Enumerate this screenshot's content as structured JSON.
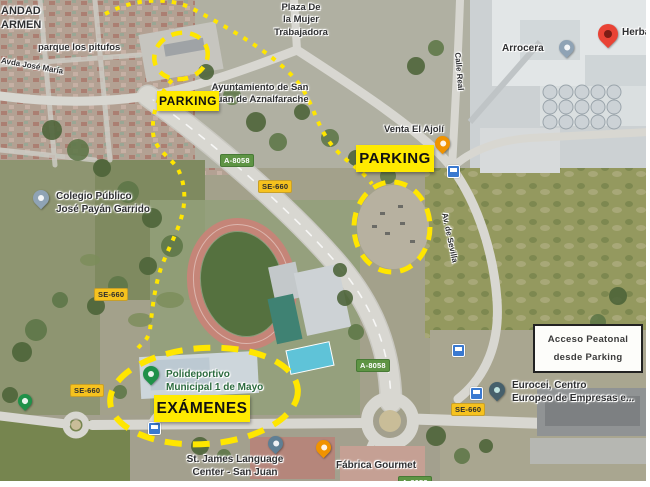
{
  "annotations": {
    "parking_top": "PARKING",
    "parking_right": "PARKING",
    "examenes": "EXÁMENES",
    "acceso_line1": "Acceso Peatonal",
    "acceso_line2": "desde Parking"
  },
  "shields": {
    "a8058": "A-8058",
    "se660": "SE-660"
  },
  "places": {
    "hermandad_line1": "ANDAD",
    "hermandad_line2": "ARMEN",
    "parque": "parque los pitufos",
    "street_jose_maria": "Avda José María",
    "plaza_line1": "Plaza De",
    "plaza_line2": "la Mujer",
    "plaza_line3": "Trabajadora",
    "ayuntamiento_line1": "Ayuntamiento de San",
    "ayuntamiento_line2": "Juan de Aznalfarache",
    "calle_real": "Calle Real",
    "av_sevilla": "Av. de Sevilla",
    "arrocera": "Arrocera",
    "herba": "Herba",
    "venta": "Venta El Ajolí",
    "colegio_line1": "Colegio Público",
    "colegio_line2": "José Payán Garrido",
    "poli_line1": "Polideportivo",
    "poli_line2": "Municipal 1 de Mayo",
    "stjames_line1": "St. James Language",
    "stjames_line2": "Center - San Juan",
    "fabrica": "Fábrica Gourmet",
    "eurocei_line1": "Eurocei, Centro",
    "eurocei_line2": "Europeo de Empresas e..."
  },
  "icons": {
    "destination_pin": "red-map-pin",
    "restaurant_pin": "orange-restaurant-pin",
    "school_pin": "blue-grey-school-pin",
    "sports_pin": "green-sports-pin",
    "park_pin": "green-park-pin",
    "language_school_pin": "grey-place-pin",
    "factory_pin": "orange-place-pin",
    "business_pin": "dark-place-pin",
    "bus_stop": "blue-bus-stop-square"
  },
  "colors": {
    "route_yellow": "#FFE600",
    "annotation_bg": "#FFEA00",
    "annotation_text": "#111111",
    "shield_yellow_bg": "#F6C21E",
    "shield_green_bg": "#5E9444",
    "pin_red": "#E94335",
    "pin_orange": "#F09300",
    "pin_green": "#1F9149",
    "pin_slate": "#5F7F94",
    "pin_blue_grey": "#8FA3B5",
    "pin_dark": "#46606C",
    "bus_blue": "#3A79D0"
  }
}
